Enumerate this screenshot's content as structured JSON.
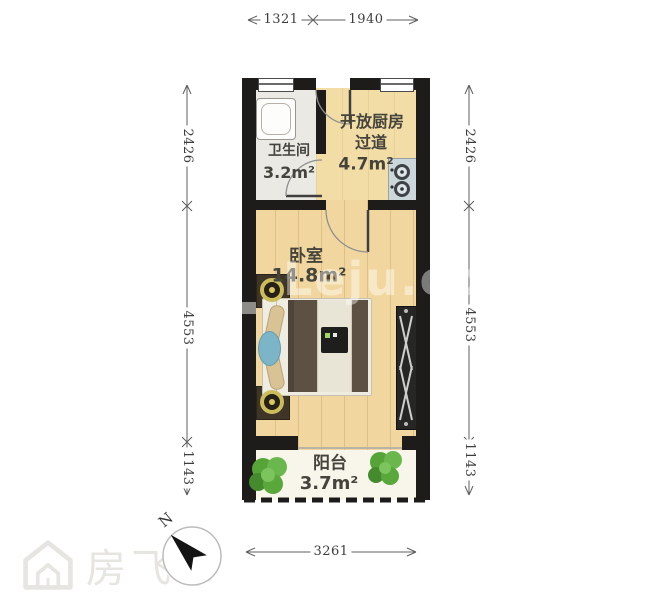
{
  "rooms": {
    "bathroom": {
      "name": "卫生间",
      "area": "3.2m²"
    },
    "kitchen": {
      "name_line1": "开放厨房",
      "name_line2": "过道",
      "area": "4.7m²"
    },
    "bedroom": {
      "name": "卧室",
      "area": "14.8m²"
    },
    "balcony": {
      "name": "阳台",
      "area": "3.7m²"
    }
  },
  "dimensions": {
    "top": [
      "1321",
      "1940"
    ],
    "left": [
      "2426",
      "4553",
      "1143"
    ],
    "right": [
      "2426",
      "4553",
      "1143"
    ],
    "bottom": [
      "3261"
    ]
  },
  "compass": {
    "label": "N"
  },
  "watermarks": {
    "brand": "房飞布",
    "site": "Leju.com"
  },
  "colors": {
    "wall": "#1d1c1a",
    "wood_floor": "#f1d79f",
    "tile_floor": "#ebe9e4",
    "balcony_floor": "#f8f5ea",
    "stove": "#ccd7dc",
    "plant_green": "#56a338",
    "bed_blanket": "#5c5142"
  }
}
